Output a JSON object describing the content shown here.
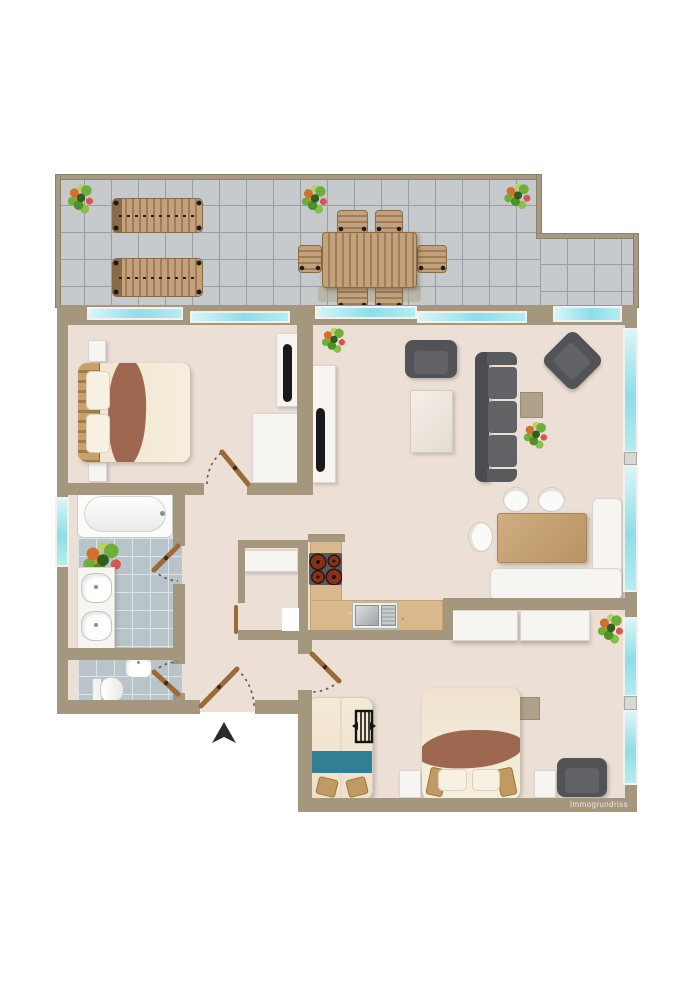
{
  "watermark": "Immogrundriss",
  "plan_type": "apartment floor plan, top-down view, unlabeled rooms",
  "palette": {
    "background": "#ffffff",
    "wall": "#a5967e",
    "floor": "#ebdfd6",
    "terrace_tile": "#c6cacd",
    "terrace_grout": "#989fa4",
    "bathroom_tile": "#b9c3ca",
    "window_glass": "#8fdde8",
    "window_frame": "#f2f1ee",
    "wood": "#b08a5e",
    "door_leaf_brown": "#9c6a38",
    "furniture_dark_gray": "#525356",
    "blanket_brown": "#9d6750",
    "blanket_teal": "#2f7f95",
    "kitchen_counter": "#d9b88c",
    "marker_black": "#1a1a1a"
  },
  "rooms": [
    {
      "name": "terrace",
      "items": [
        "potted plant",
        "potted plant",
        "potted plant",
        "sun lounger",
        "sun lounger",
        "garden dining table",
        "six garden chairs"
      ]
    },
    {
      "name": "living-room",
      "items": [
        "armchair",
        "rug",
        "three-seat sofa",
        "side table",
        "potted plant",
        "corner armchair rotated 45deg",
        "tv sideboard with wall tv",
        "potted plant near partition",
        "dining table",
        "l-shaped corner bench",
        "three round chairs"
      ]
    },
    {
      "name": "bedroom-1",
      "items": [
        "double bed with brown blanket",
        "nightstand",
        "nightstand",
        "wardrobe",
        "tv sideboard with wall tv"
      ]
    },
    {
      "name": "bathroom",
      "items": [
        "bathtub",
        "washbasin counter with two basins",
        "potted plant"
      ]
    },
    {
      "name": "wc",
      "items": [
        "toilet",
        "small washbasin"
      ]
    },
    {
      "name": "kitchen",
      "items": [
        "l-shaped counter",
        "four-burner hob",
        "double sink with drainer",
        "storage niche with white cabinet"
      ]
    },
    {
      "name": "bedroom-2",
      "items": [
        "double bed with brown blanket",
        "nightstand",
        "nightstand",
        "child cot with teal blanket",
        "cot symbol",
        "wardrobe two panels",
        "side table",
        "armchair",
        "potted plant"
      ]
    },
    {
      "name": "hallway",
      "items": [
        "entrance door",
        "entrance arrow marker"
      ]
    }
  ],
  "doors": [
    "entrance door",
    "bedroom-1 door",
    "bathroom door",
    "wc door",
    "bedroom-2 door",
    "storage niche door"
  ],
  "windows": [
    "bedroom-1 terrace windows x2",
    "living-room terrace sliding doors x2",
    "top framed window",
    "bathroom left window",
    "right wall window x4 with handles"
  ],
  "markers": {
    "entrance_arrow": "black triangle pointing up",
    "cot_symbol": "black barred cot glyph"
  }
}
